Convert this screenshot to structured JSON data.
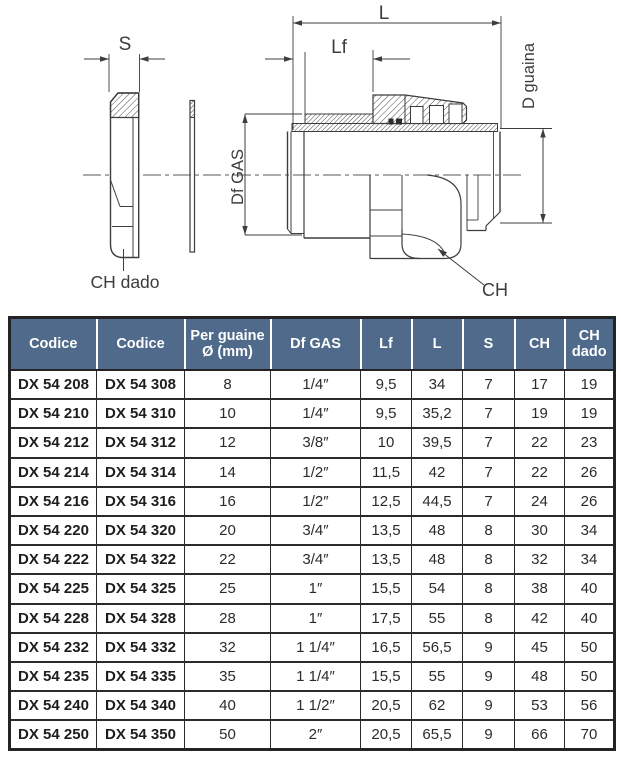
{
  "diagram": {
    "labels": {
      "s": "S",
      "l": "L",
      "lf": "Lf",
      "df_gas": "Df GAS",
      "d_guaina": "D guaina",
      "ch": "CH",
      "ch_dado": "CH dado"
    }
  },
  "table": {
    "header_bg": "#4f6a8a",
    "columns": [
      "Codice",
      "Codice",
      "Per guaine\nØ (mm)",
      "Df GAS",
      "Lf",
      "L",
      "S",
      "CH",
      "CH\ndado"
    ],
    "rows": [
      [
        "DX 54 208",
        "DX 54 308",
        "8",
        "1/4″",
        "9,5",
        "34",
        "7",
        "17",
        "19"
      ],
      [
        "DX 54 210",
        "DX 54 310",
        "10",
        "1/4″",
        "9,5",
        "35,2",
        "7",
        "19",
        "19"
      ],
      [
        "DX 54 212",
        "DX 54 312",
        "12",
        "3/8″",
        "10",
        "39,5",
        "7",
        "22",
        "23"
      ],
      [
        "DX 54 214",
        "DX 54 314",
        "14",
        "1/2″",
        "11,5",
        "42",
        "7",
        "22",
        "26"
      ],
      [
        "DX 54 216",
        "DX 54 316",
        "16",
        "1/2″",
        "12,5",
        "44,5",
        "7",
        "24",
        "26"
      ],
      [
        "DX 54 220",
        "DX 54 320",
        "20",
        "3/4″",
        "13,5",
        "48",
        "8",
        "30",
        "34"
      ],
      [
        "DX 54 222",
        "DX 54 322",
        "22",
        "3/4″",
        "13,5",
        "48",
        "8",
        "32",
        "34"
      ],
      [
        "DX 54 225",
        "DX 54 325",
        "25",
        "1″",
        "15,5",
        "54",
        "8",
        "38",
        "40"
      ],
      [
        "DX 54 228",
        "DX 54 328",
        "28",
        "1″",
        "17,5",
        "55",
        "8",
        "42",
        "40"
      ],
      [
        "DX 54 232",
        "DX 54 332",
        "32",
        "1 1/4″",
        "16,5",
        "56,5",
        "9",
        "45",
        "50"
      ],
      [
        "DX 54 235",
        "DX 54 335",
        "35",
        "1 1/4″",
        "15,5",
        "55",
        "9",
        "48",
        "50"
      ],
      [
        "DX 54 240",
        "DX 54 340",
        "40",
        "1 1/2″",
        "20,5",
        "62",
        "9",
        "53",
        "56"
      ],
      [
        "DX 54 250",
        "DX 54 350",
        "50",
        "2″",
        "20,5",
        "65,5",
        "9",
        "66",
        "70"
      ]
    ]
  }
}
